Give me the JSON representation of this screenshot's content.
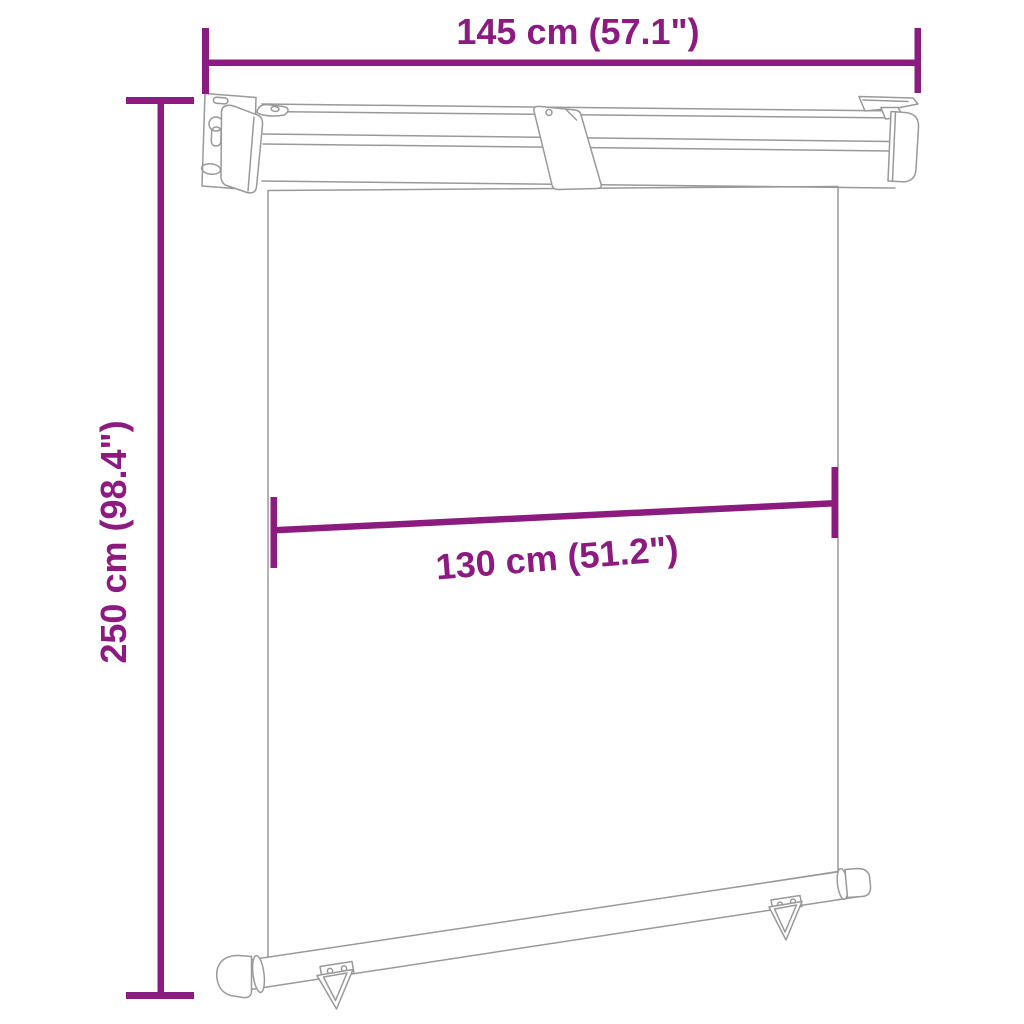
{
  "diagram": {
    "title": "awning-dimension-diagram",
    "dimensions": {
      "width_top": {
        "label": "145 cm (57.1\")"
      },
      "height_left": {
        "label": "250 cm (98.4\")"
      },
      "width_middle": {
        "label": "130 cm (51.2\")"
      }
    },
    "colors": {
      "dimension_color": "#8C1B80",
      "drawing_line_color": "#98999b",
      "background_color": "#ffffff"
    }
  }
}
